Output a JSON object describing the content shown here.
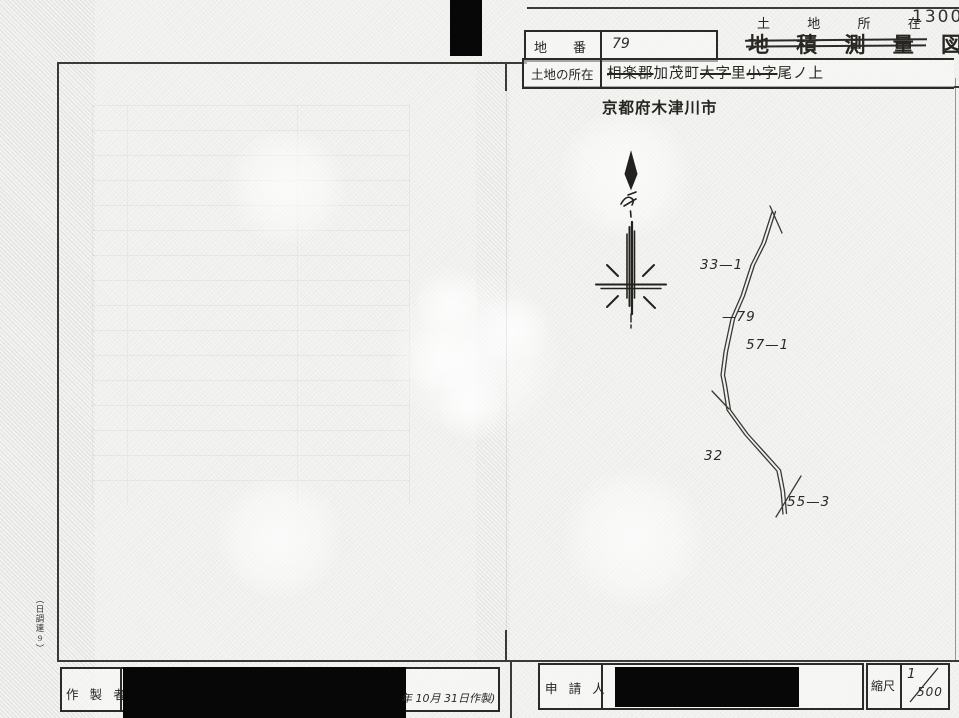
{
  "page": {
    "doc_number": "1300",
    "title_small": "土 地 所 在 図",
    "title_large": "地 積 測 量 図"
  },
  "header": {
    "lot_field": {
      "label": "地　　番",
      "value": "79"
    },
    "location_field": {
      "label": "土地の所在",
      "parts": [
        {
          "text": "相楽郡",
          "struck": true
        },
        {
          "text": "加茂町",
          "struck": false
        },
        {
          "text": "大字",
          "struck": true
        },
        {
          "text": "里",
          "struck": false
        },
        {
          "text": "小字",
          "struck": true
        },
        {
          "text": "尾ノ上",
          "struck": false
        }
      ]
    },
    "city_note": "京都府木津川市"
  },
  "map": {
    "parcel_labels": [
      {
        "text": "33—1"
      },
      {
        "text": "—79"
      },
      {
        "text": "57—1"
      },
      {
        "text": "32"
      },
      {
        "text": "55—3"
      }
    ]
  },
  "footer": {
    "maker_label": "作 製 者",
    "made_date_note": "年 10月  31日作製)",
    "applicant_label": "申 請 人",
    "scale_label": "縮尺",
    "scale_numerator": "1",
    "scale_denominator": "500"
  },
  "margin": {
    "form_code": "（日調連9）"
  }
}
